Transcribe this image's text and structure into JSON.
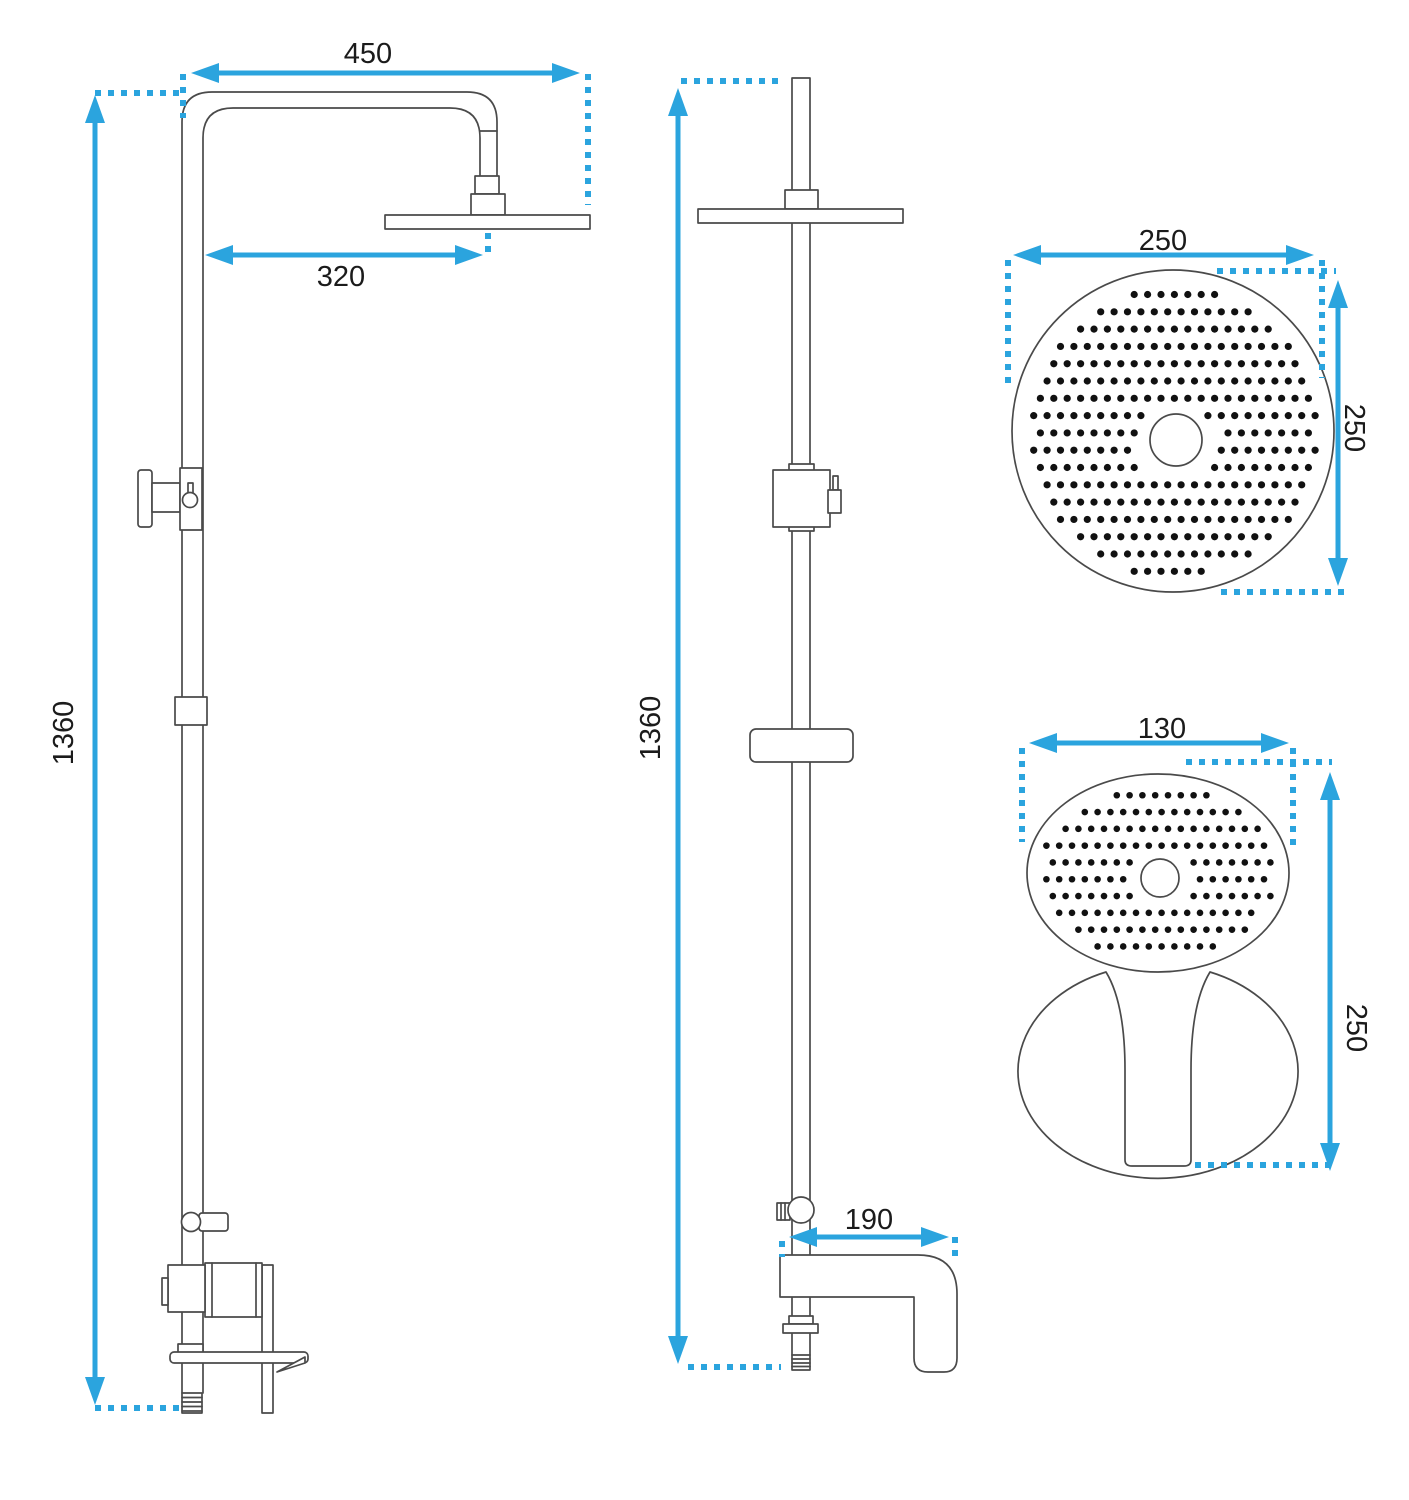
{
  "colors": {
    "dimension_blue": "#2ba4de",
    "drawing_line_gray": "#4a4a4a",
    "nozzle_dot_black": "#111111",
    "background": "#ffffff"
  },
  "views": {
    "front": {
      "dims": {
        "arm_width": "450",
        "head_offset": "320",
        "height": "1360"
      }
    },
    "side": {
      "dims": {
        "height": "1360",
        "spout_length": "190"
      }
    },
    "rain_head": {
      "dims": {
        "width": "250",
        "height": "250"
      }
    },
    "hand_shower": {
      "dims": {
        "width": "130",
        "length": "250"
      }
    }
  }
}
